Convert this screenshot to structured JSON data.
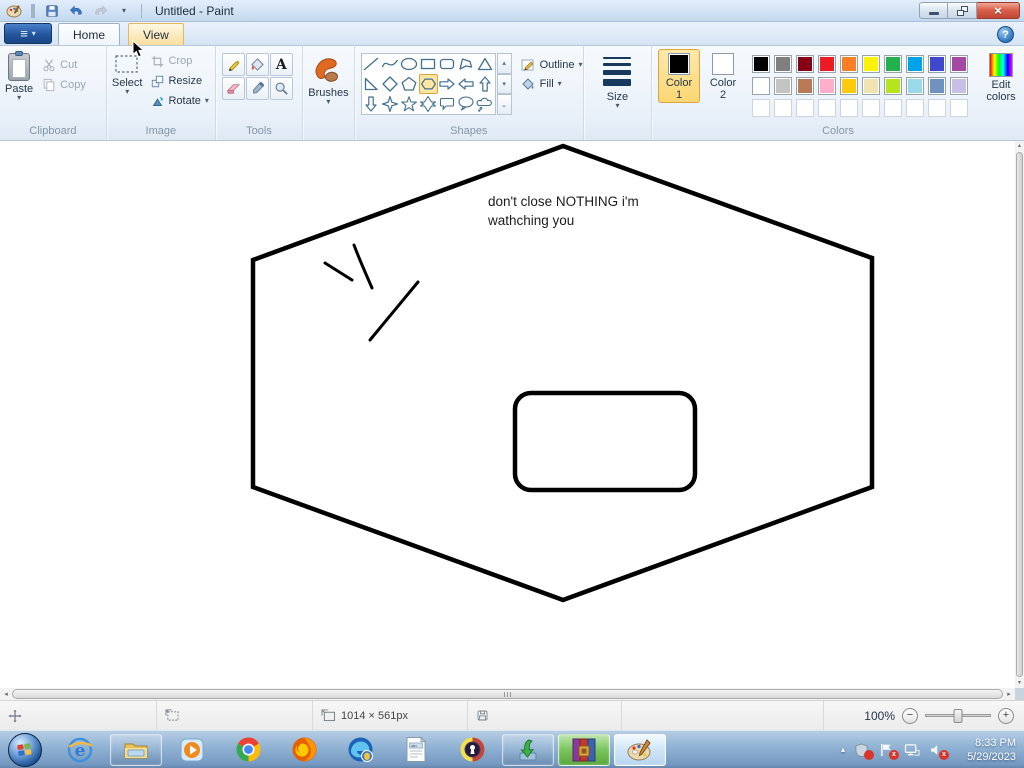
{
  "window": {
    "title": "Untitled - Paint",
    "help_glyph": "?"
  },
  "icons": {
    "dropdown": "▾",
    "close": "×",
    "menu_list": "≡",
    "scroll_up": "▴",
    "scroll_down": "▾",
    "scroll_more": "⌄",
    "scroll_left": "◂",
    "scroll_right": "▸",
    "tray_expand": "▴",
    "zoom_out": "−",
    "zoom_in": "+",
    "text_tool": "A",
    "ie_glyph": "e",
    "badge_x": "x"
  },
  "tabs": {
    "home": "Home",
    "view": "View"
  },
  "ribbon": {
    "clipboard": {
      "label": "Clipboard",
      "paste": "Paste",
      "cut": "Cut",
      "copy": "Copy"
    },
    "image": {
      "label": "Image",
      "select": "Select",
      "crop": "Crop",
      "resize": "Resize",
      "rotate": "Rotate"
    },
    "tools": {
      "label": "Tools"
    },
    "brushes": {
      "label": "Brushes"
    },
    "shapes": {
      "label": "Shapes",
      "outline": "Outline",
      "fill": "Fill",
      "selected_shape": "hexagon",
      "shape_names": [
        "line",
        "curve",
        "oval",
        "rectangle",
        "rounded-rectangle",
        "polygon",
        "triangle",
        "right-triangle",
        "diamond",
        "pentagon",
        "hexagon",
        "right-arrow",
        "left-arrow",
        "up-arrow",
        "down-arrow",
        "four-point-star",
        "five-point-star",
        "six-point-star",
        "rounded-callout",
        "oval-callout",
        "cloud-callout"
      ]
    },
    "size": {
      "label": "Size"
    },
    "colors": {
      "label": "Colors",
      "color1_label": "Color 1",
      "color2_label": "Color 2",
      "edit_label": "Edit colors",
      "color1": "#000000",
      "color2": "#ffffff",
      "palette": [
        [
          "#000000",
          "#7f7f7f",
          "#880015",
          "#ed1c24",
          "#ff7f27",
          "#fff200",
          "#22b14c",
          "#00a2e8",
          "#3f48cc",
          "#a349a4"
        ],
        [
          "#ffffff",
          "#c3c3c3",
          "#b97a57",
          "#ffaec9",
          "#ffc90e",
          "#efe4b0",
          "#b5e61d",
          "#99d9ea",
          "#7092be",
          "#c8bfe7"
        ]
      ],
      "empty_cells": 10
    }
  },
  "canvas": {
    "text_line1": "don't close NOTHING i'm",
    "text_line2": "wathching you",
    "ink": "#000000"
  },
  "status_bar": {
    "canvas_size": "1014 × 561px",
    "zoom_level": "100%"
  },
  "taskbar": {
    "clock_time": "8:33 PM",
    "clock_date": "5/29/2023",
    "apps": [
      "start",
      "internet-explorer",
      "windows-explorer",
      "media-player",
      "chrome",
      "firefox",
      "edge-browser",
      "notepad",
      "tor-browser",
      "download-manager",
      "winrar",
      "paint"
    ]
  }
}
